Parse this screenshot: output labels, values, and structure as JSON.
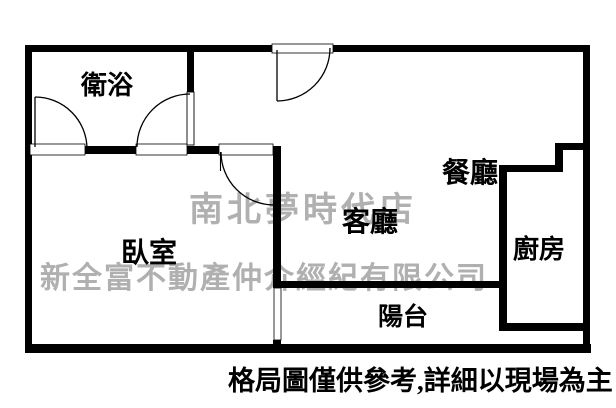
{
  "floorplan": {
    "type": "apartment-floor-plan",
    "rooms": [
      {
        "id": "bathroom",
        "label": "衛浴"
      },
      {
        "id": "bedroom",
        "label": "臥室"
      },
      {
        "id": "living",
        "label": "客廳"
      },
      {
        "id": "dining",
        "label": "餐廳"
      },
      {
        "id": "kitchen",
        "label": "廚房"
      },
      {
        "id": "balcony",
        "label": "陽台"
      }
    ],
    "watermark": {
      "line1": "南北夢時代店",
      "line2": "新全富不動產仲介經紀有限公司"
    },
    "disclaimer": "格局圖僅供參考,詳細以現場為主",
    "colors": {
      "background": "#ffffff",
      "wall": "#000000",
      "label": "#000000",
      "watermark": "#b0b0b0"
    }
  }
}
